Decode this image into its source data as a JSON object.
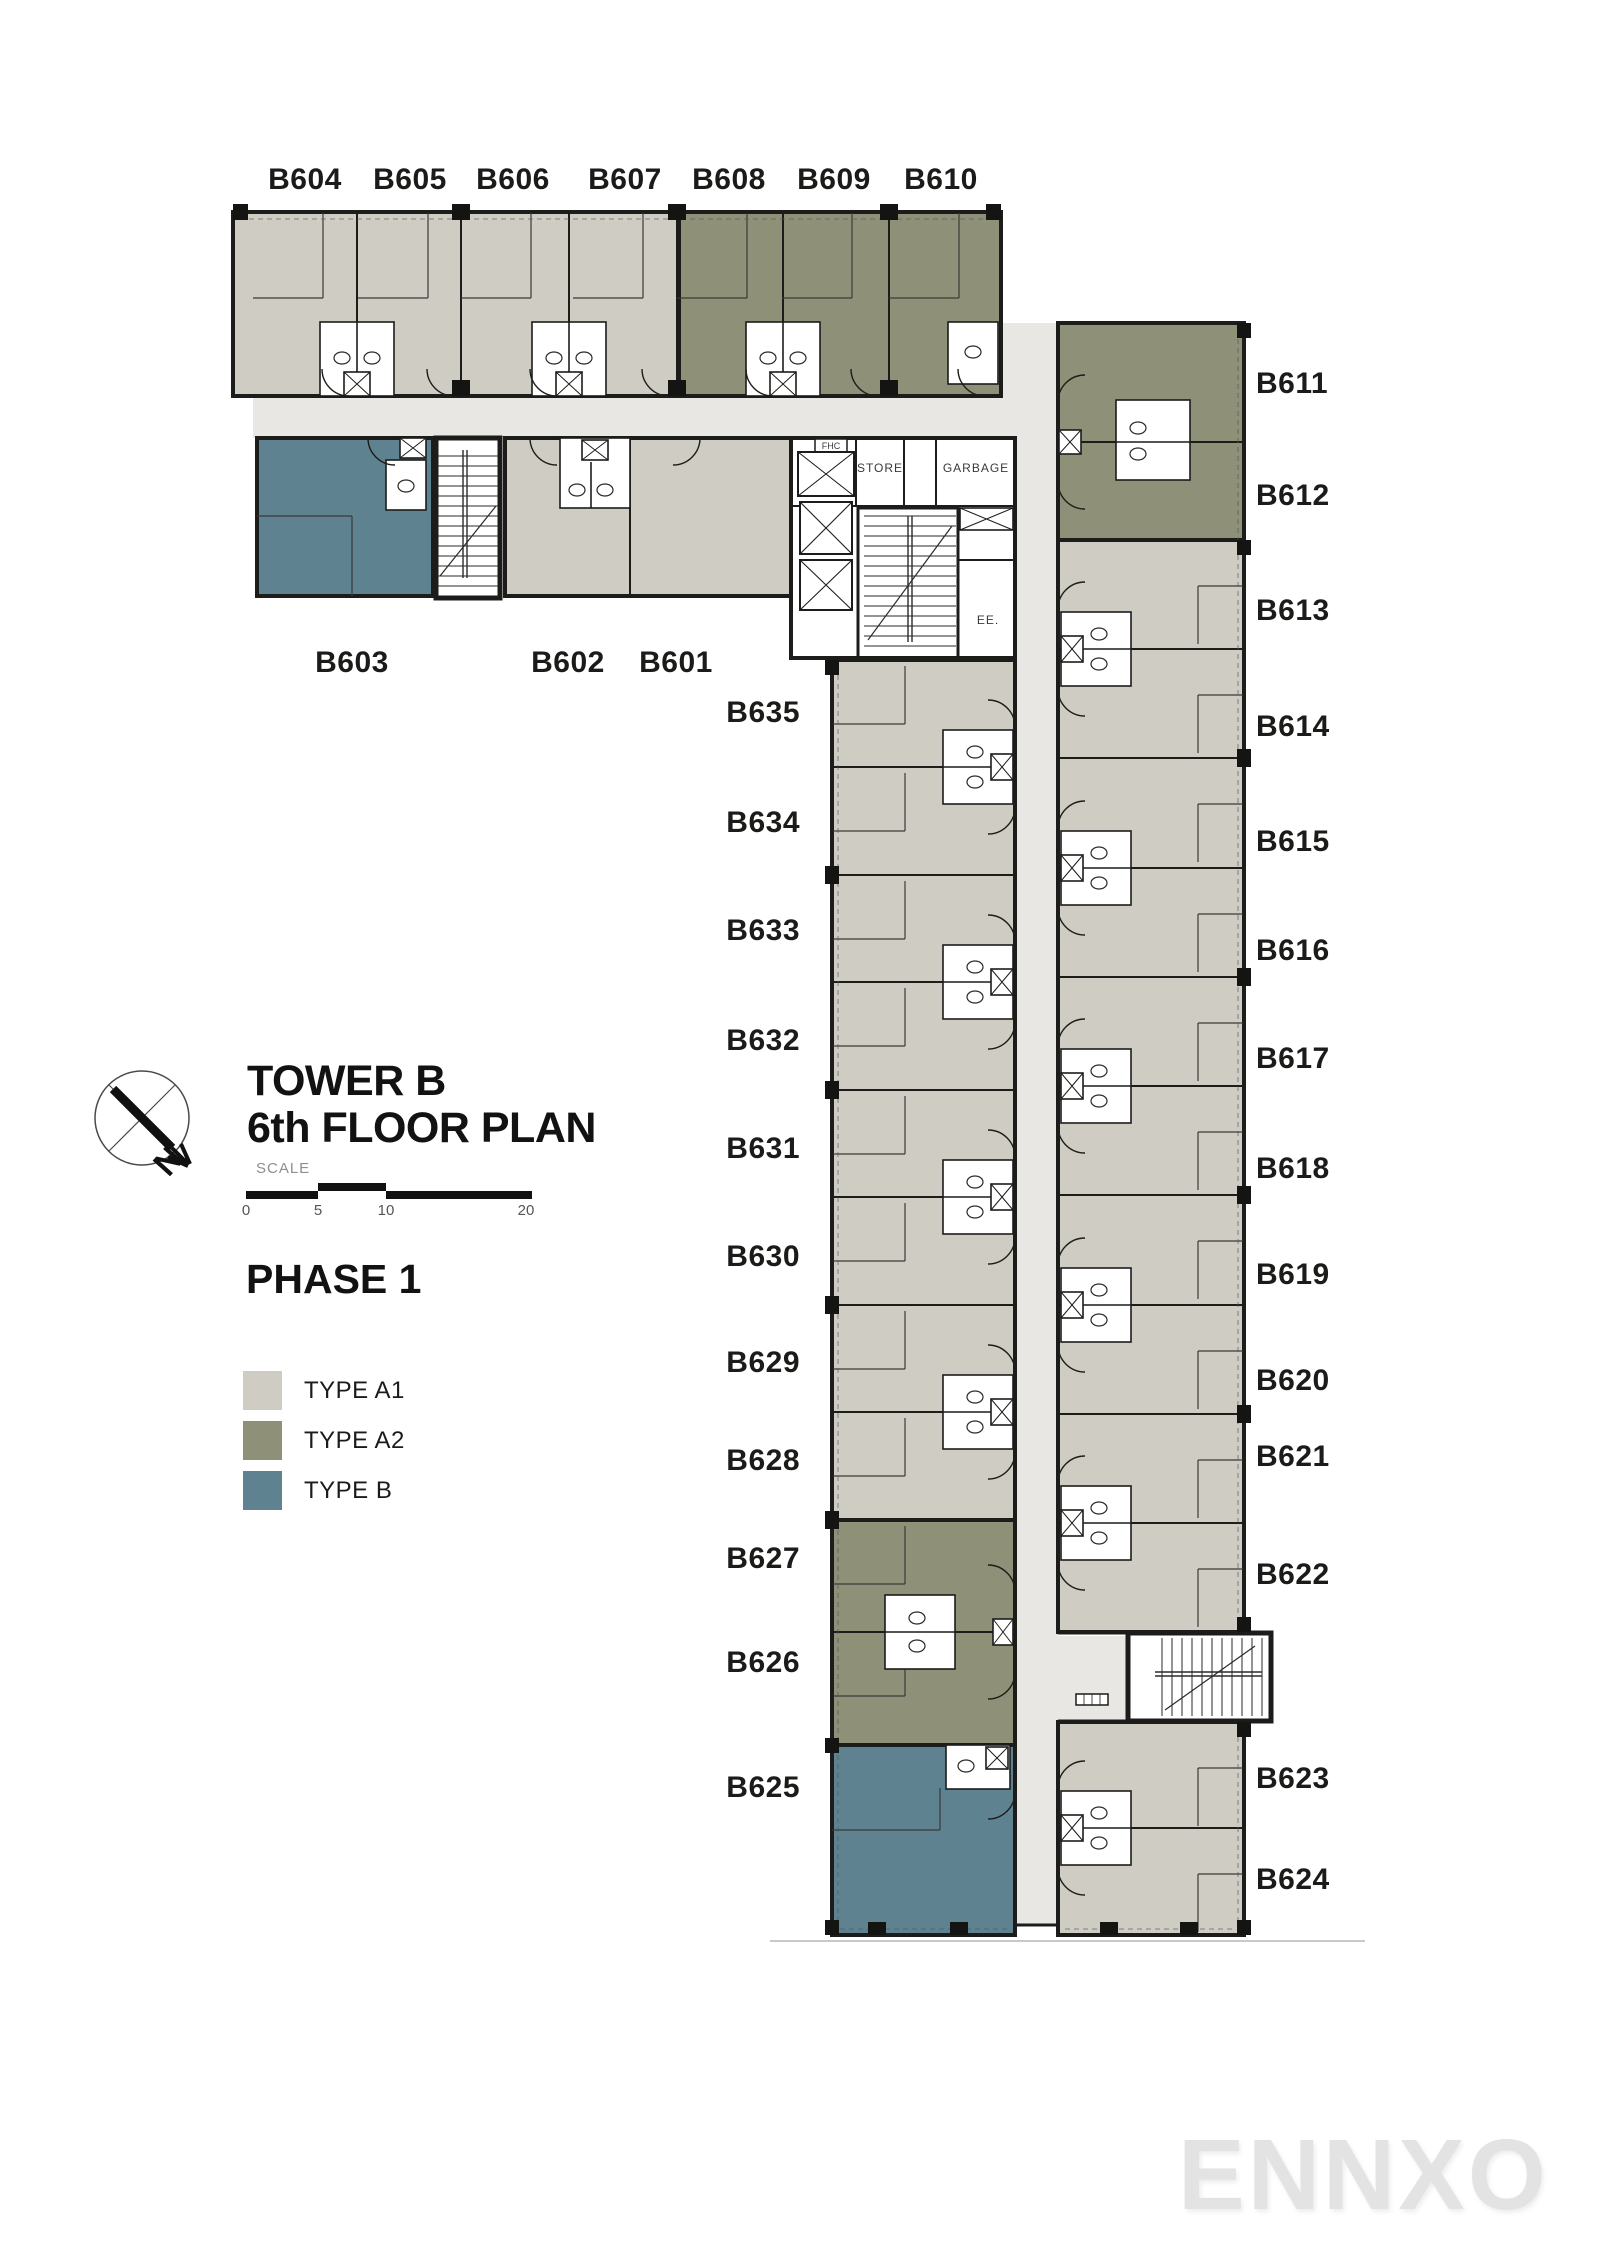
{
  "title": {
    "line1": "TOWER B",
    "line2": "6th FLOOR PLAN"
  },
  "scale": {
    "label": "SCALE",
    "ticks": [
      "0",
      "5",
      "10",
      "20"
    ]
  },
  "phase_label": "PHASE 1",
  "north_letter": "N",
  "watermark": "ENNXO",
  "legend": {
    "items": [
      {
        "label": "TYPE A1",
        "color": "#cfccc4"
      },
      {
        "label": "TYPE A2",
        "color": "#8e9077"
      },
      {
        "label": "TYPE B",
        "color": "#5f8290"
      }
    ]
  },
  "core_labels": {
    "fhc": "FHC",
    "store": "STORE",
    "garbage": "GARBAGE",
    "electrical": "EE."
  },
  "unit_types": {
    "type_A1": [
      "B601",
      "B602",
      "B604",
      "B605",
      "B606",
      "B607",
      "B613",
      "B614",
      "B615",
      "B616",
      "B617",
      "B618",
      "B619",
      "B620",
      "B621",
      "B622",
      "B623",
      "B624",
      "B628",
      "B629",
      "B630",
      "B631",
      "B632",
      "B633",
      "B634",
      "B635"
    ],
    "type_A2": [
      "B608",
      "B609",
      "B610",
      "B611",
      "B612",
      "B626",
      "B627"
    ],
    "type_B": [
      "B603",
      "B625"
    ]
  },
  "unit_labels": [
    {
      "id": "B604",
      "x": 305,
      "y": 189,
      "anchor": "middle"
    },
    {
      "id": "B605",
      "x": 410,
      "y": 189,
      "anchor": "middle"
    },
    {
      "id": "B606",
      "x": 513,
      "y": 189,
      "anchor": "middle"
    },
    {
      "id": "B607",
      "x": 625,
      "y": 189,
      "anchor": "middle"
    },
    {
      "id": "B608",
      "x": 729,
      "y": 189,
      "anchor": "middle"
    },
    {
      "id": "B609",
      "x": 834,
      "y": 189,
      "anchor": "middle"
    },
    {
      "id": "B610",
      "x": 941,
      "y": 189,
      "anchor": "middle"
    },
    {
      "id": "B603",
      "x": 352,
      "y": 672,
      "anchor": "middle"
    },
    {
      "id": "B602",
      "x": 568,
      "y": 672,
      "anchor": "middle"
    },
    {
      "id": "B601",
      "x": 676,
      "y": 672,
      "anchor": "middle"
    },
    {
      "id": "B635",
      "x": 800,
      "y": 722,
      "anchor": "end"
    },
    {
      "id": "B634",
      "x": 800,
      "y": 832,
      "anchor": "end"
    },
    {
      "id": "B633",
      "x": 800,
      "y": 940,
      "anchor": "end"
    },
    {
      "id": "B632",
      "x": 800,
      "y": 1050,
      "anchor": "end"
    },
    {
      "id": "B631",
      "x": 800,
      "y": 1158,
      "anchor": "end"
    },
    {
      "id": "B630",
      "x": 800,
      "y": 1266,
      "anchor": "end"
    },
    {
      "id": "B629",
      "x": 800,
      "y": 1372,
      "anchor": "end"
    },
    {
      "id": "B628",
      "x": 800,
      "y": 1470,
      "anchor": "end"
    },
    {
      "id": "B627",
      "x": 800,
      "y": 1568,
      "anchor": "end"
    },
    {
      "id": "B626",
      "x": 800,
      "y": 1672,
      "anchor": "end"
    },
    {
      "id": "B625",
      "x": 800,
      "y": 1797,
      "anchor": "end"
    },
    {
      "id": "B611",
      "x": 1256,
      "y": 393,
      "anchor": "start"
    },
    {
      "id": "B612",
      "x": 1256,
      "y": 505,
      "anchor": "start"
    },
    {
      "id": "B613",
      "x": 1256,
      "y": 620,
      "anchor": "start"
    },
    {
      "id": "B614",
      "x": 1256,
      "y": 736,
      "anchor": "start"
    },
    {
      "id": "B615",
      "x": 1256,
      "y": 851,
      "anchor": "start"
    },
    {
      "id": "B616",
      "x": 1256,
      "y": 960,
      "anchor": "start"
    },
    {
      "id": "B617",
      "x": 1256,
      "y": 1068,
      "anchor": "start"
    },
    {
      "id": "B618",
      "x": 1256,
      "y": 1178,
      "anchor": "start"
    },
    {
      "id": "B619",
      "x": 1256,
      "y": 1284,
      "anchor": "start"
    },
    {
      "id": "B620",
      "x": 1256,
      "y": 1390,
      "anchor": "start"
    },
    {
      "id": "B621",
      "x": 1256,
      "y": 1466,
      "anchor": "start"
    },
    {
      "id": "B622",
      "x": 1256,
      "y": 1584,
      "anchor": "start"
    },
    {
      "id": "B623",
      "x": 1256,
      "y": 1788,
      "anchor": "start"
    },
    {
      "id": "B624",
      "x": 1256,
      "y": 1889,
      "anchor": "start"
    }
  ]
}
